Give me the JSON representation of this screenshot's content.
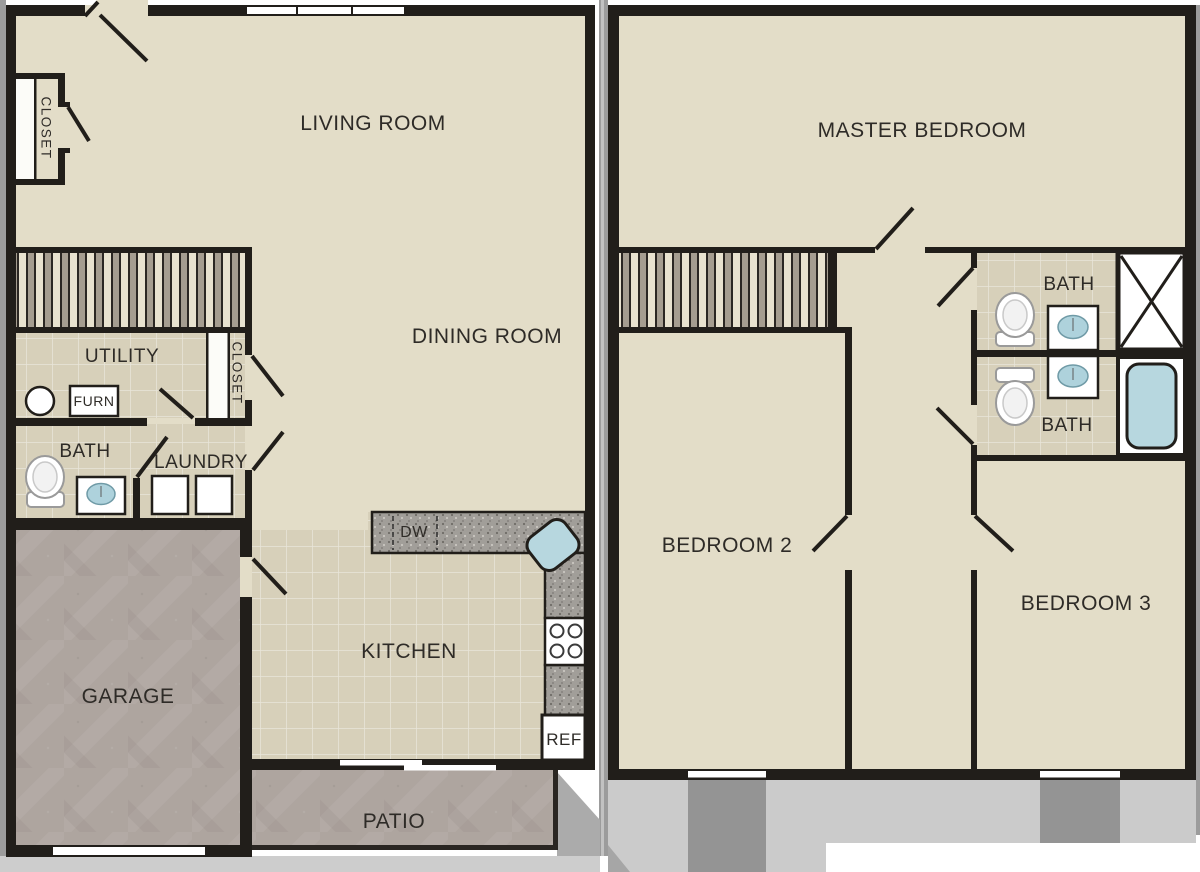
{
  "title": "Two-story townhome floor plan",
  "first_floor": {
    "living_room": "LIVING ROOM",
    "dining_room": "DINING ROOM",
    "entry_closet": "CLOSET",
    "utility_room": "UTILITY",
    "furnace": "FURN",
    "hall_closet": "CLOSET",
    "bathroom": "BATH",
    "laundry": "LAUNDRY",
    "garage": "GARAGE",
    "kitchen": "KITCHEN",
    "dishwasher": "DW",
    "refrigerator": "REF",
    "patio": "PATIO"
  },
  "second_floor": {
    "master_bedroom": "MASTER BEDROOM",
    "bathroom_upper": "BATH",
    "bathroom_lower": "BATH",
    "bedroom_2": "BEDROOM 2",
    "bedroom_3": "BEDROOM 3"
  },
  "colors": {
    "wall": "#211e1a",
    "floor_beige": "#e3ddc8",
    "floor_tile": "#d7d0ba",
    "concrete": "#aea59f",
    "granite_counter": "#a19e99",
    "water_blue": "#b7d7df",
    "ground_light": "#cbcbcb",
    "ground_dark": "#949494"
  }
}
